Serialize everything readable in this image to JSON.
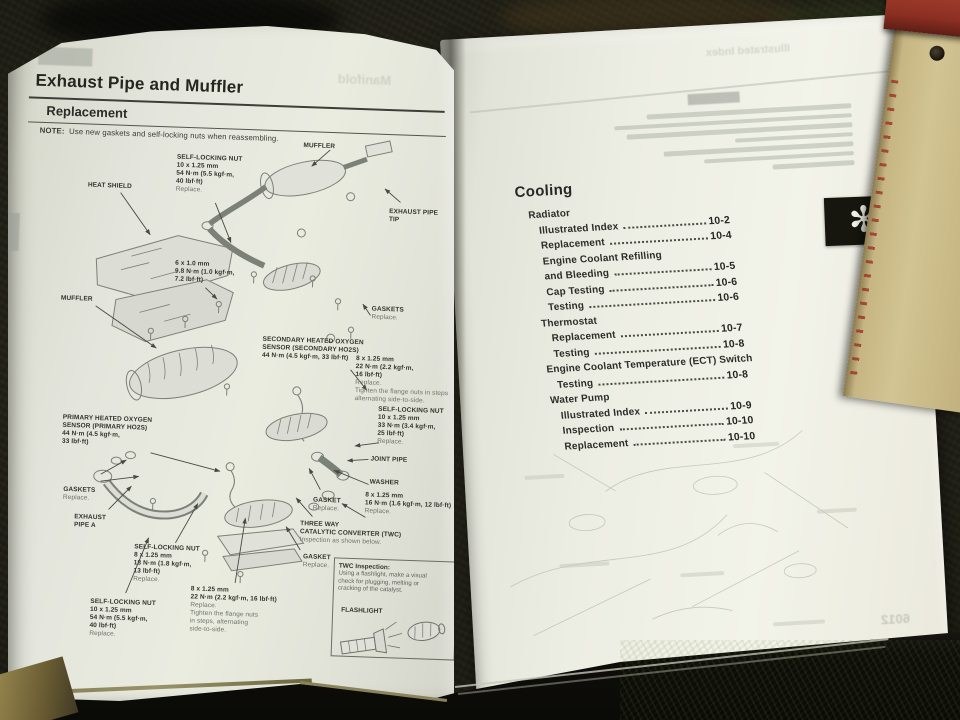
{
  "colors": {
    "page": "#e9ebe0",
    "ink": "#2c2e29",
    "muted_ink": "#6d7268",
    "tab_black": "#16160f",
    "tan_book": "#c7b684",
    "red_book": "#8c2f22",
    "carpet": "#1b1a13"
  },
  "left_page": {
    "title": "Exhaust Pipe and Muffler",
    "section": "Replacement",
    "note_label": "NOTE:",
    "note_text": "Use new gaskets and self-locking nuts when reassembling.",
    "page_number": "9-4",
    "bleed_text": "Manifold",
    "labels": [
      {
        "lines": [
          "SELF-LOCKING NUT",
          "10 x 1.25 mm",
          "54 N·m (5.5 kgf·m,",
          "40 lbf·ft)",
          "Replace."
        ],
        "light_from": 4
      },
      {
        "lines": [
          "MUFFLER"
        ]
      },
      {
        "lines": [
          "HEAT SHIELD"
        ]
      },
      {
        "lines": [
          "EXHAUST PIPE",
          "TIP"
        ]
      },
      {
        "lines": [
          "6 x 1.0 mm",
          "9.8 N·m (1.0 kgf·m,",
          "7.2 lbf·ft)"
        ]
      },
      {
        "lines": [
          "MUFFLER"
        ]
      },
      {
        "lines": [
          "SECONDARY HEATED OXYGEN",
          "SENSOR (SECONDARY HO2S)",
          "44 N·m (4.5 kgf·m, 33 lbf·ft)"
        ]
      },
      {
        "lines": [
          "GASKETS",
          "Replace."
        ],
        "light_from": 1
      },
      {
        "lines": [
          "8 x 1.25 mm",
          "22 N·m (2.2 kgf·m,",
          "16 lbf·ft)",
          "Replace.",
          "Tighten the flange nuts in steps",
          "alternating side-to-side."
        ],
        "light_from": 3
      },
      {
        "lines": [
          "SELF-LOCKING NUT",
          "10 x 1.25 mm",
          "33 N·m (3.4 kgf·m,",
          "25 lbf·ft)",
          "Replace."
        ],
        "light_from": 4
      },
      {
        "lines": [
          "PRIMARY HEATED OXYGEN",
          "SENSOR (PRIMARY HO2S)",
          "44 N·m (4.5 kgf·m,",
          "33 lbf·ft)"
        ]
      },
      {
        "lines": [
          "JOINT PIPE"
        ]
      },
      {
        "lines": [
          "WASHER"
        ]
      },
      {
        "lines": [
          "GASKETS",
          "Replace."
        ],
        "light_from": 1
      },
      {
        "lines": [
          "GASKET",
          "Replace."
        ],
        "light_from": 1
      },
      {
        "lines": [
          "8 x 1.25 mm",
          "16 N·m (1.6 kgf·m, 12 lbf·ft)",
          "Replace."
        ],
        "light_from": 2
      },
      {
        "lines": [
          "EXHAUST",
          "PIPE A"
        ]
      },
      {
        "lines": [
          "SELF-LOCKING NUT",
          "8 x 1.25 mm",
          "18 N·m (1.8 kgf·m,",
          "13 lbf·ft)",
          "Replace."
        ],
        "light_from": 4
      },
      {
        "lines": [
          "GASKET",
          "Replace."
        ],
        "light_from": 1
      },
      {
        "lines": [
          "THREE WAY",
          "CATALYTIC CONVERTER (TWC)",
          "Inspection as shown below."
        ],
        "light_from": 2
      },
      {
        "lines": [
          "SELF-LOCKING NUT",
          "10 x 1.25 mm",
          "54 N·m (5.5 kgf·m,",
          "40 lbf·ft)",
          "Replace."
        ],
        "light_from": 4
      },
      {
        "lines": [
          "8 x 1.25 mm",
          "22 N·m (2.2 kgf·m, 16 lbf·ft)",
          "Replace.",
          "Tighten the flange nuts",
          "in steps, alternating",
          "side-to-side."
        ],
        "light_from": 2
      }
    ],
    "twc_box": {
      "title": "TWC Inspection:",
      "lines": [
        "Using a flashlight, make a visual",
        "check for plugging, melting or",
        "cracking of the catalyst."
      ],
      "flashlight_label": "FLASHLIGHT"
    }
  },
  "right_page": {
    "heading": "Cooling",
    "tab_symbol": "✻",
    "bleed_text": "Illustrated Index",
    "bleed_number": "6012",
    "toc": [
      {
        "label": "Radiator",
        "indent": 0
      },
      {
        "label": "Illustrated Index",
        "page": "10-2",
        "indent": 1
      },
      {
        "label": "Replacement",
        "page": "10-4",
        "indent": 1
      },
      {
        "label": "Engine Coolant Refilling",
        "indent": 1
      },
      {
        "label": "and Bleeding",
        "page": "10-5",
        "indent": 1
      },
      {
        "label": "Cap Testing",
        "page": "10-6",
        "indent": 1
      },
      {
        "label": "Testing",
        "page": "10-6",
        "indent": 1
      },
      {
        "label": "Thermostat",
        "indent": 0
      },
      {
        "label": "Replacement",
        "page": "10-7",
        "indent": 1
      },
      {
        "label": "Testing",
        "page": "10-8",
        "indent": 1
      },
      {
        "label": "Engine Coolant Temperature (ECT) Switch",
        "indent": 0
      },
      {
        "label": "Testing",
        "page": "10-8",
        "indent": 1
      },
      {
        "label": "Water Pump",
        "indent": 0
      },
      {
        "label": "Illustrated Index",
        "page": "10-9",
        "indent": 1
      },
      {
        "label": "Inspection",
        "page": "10-10",
        "indent": 1
      },
      {
        "label": "Replacement",
        "page": "10-10",
        "indent": 1
      }
    ]
  }
}
